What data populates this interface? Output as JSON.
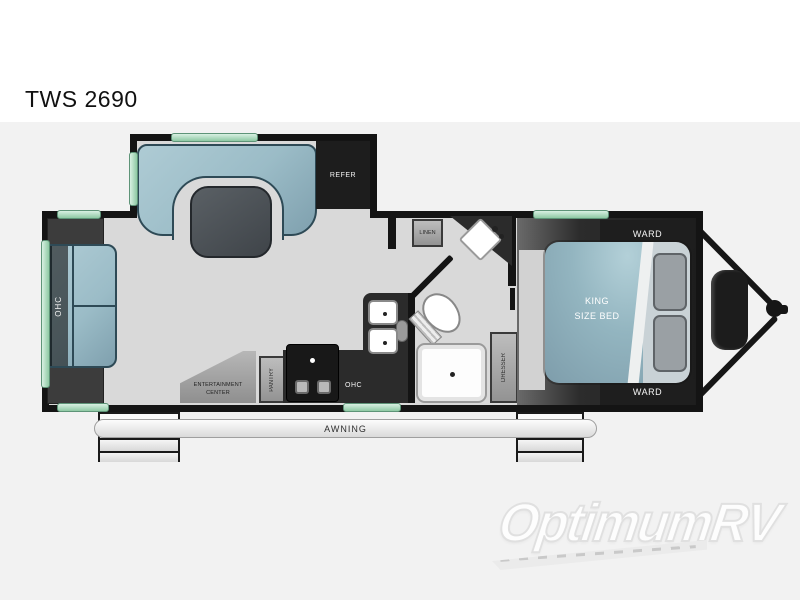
{
  "title": "TWS 2690",
  "watermark": "OptimumRV",
  "labels": {
    "refer": "REFER",
    "linen": "LINEN",
    "ward_top": "WARD",
    "ward_bottom": "WARD",
    "king_line1": "KING",
    "king_line2": "SIZE BED",
    "ohc_rear": "OHC",
    "ohc_kitchen": "OHC",
    "ent_line1": "ENTERTAINMENT",
    "ent_line2": "CENTER",
    "pantry": "PANTRY",
    "dresser": "DRESSER",
    "awning": "AWNING"
  },
  "colors": {
    "wall": "#141414",
    "floor": "#d9d9d9",
    "upholstery_blue": "#9fc0ca",
    "window_green": "#9ed3b4",
    "cabinet_gray": "#a3a3a3",
    "counter_dark": "#2b2b2b",
    "fixture_white": "#fdfdfd",
    "page_band": "#f2f2f2",
    "title_text": "#111111",
    "watermark_gray": "#e0e0e0"
  }
}
